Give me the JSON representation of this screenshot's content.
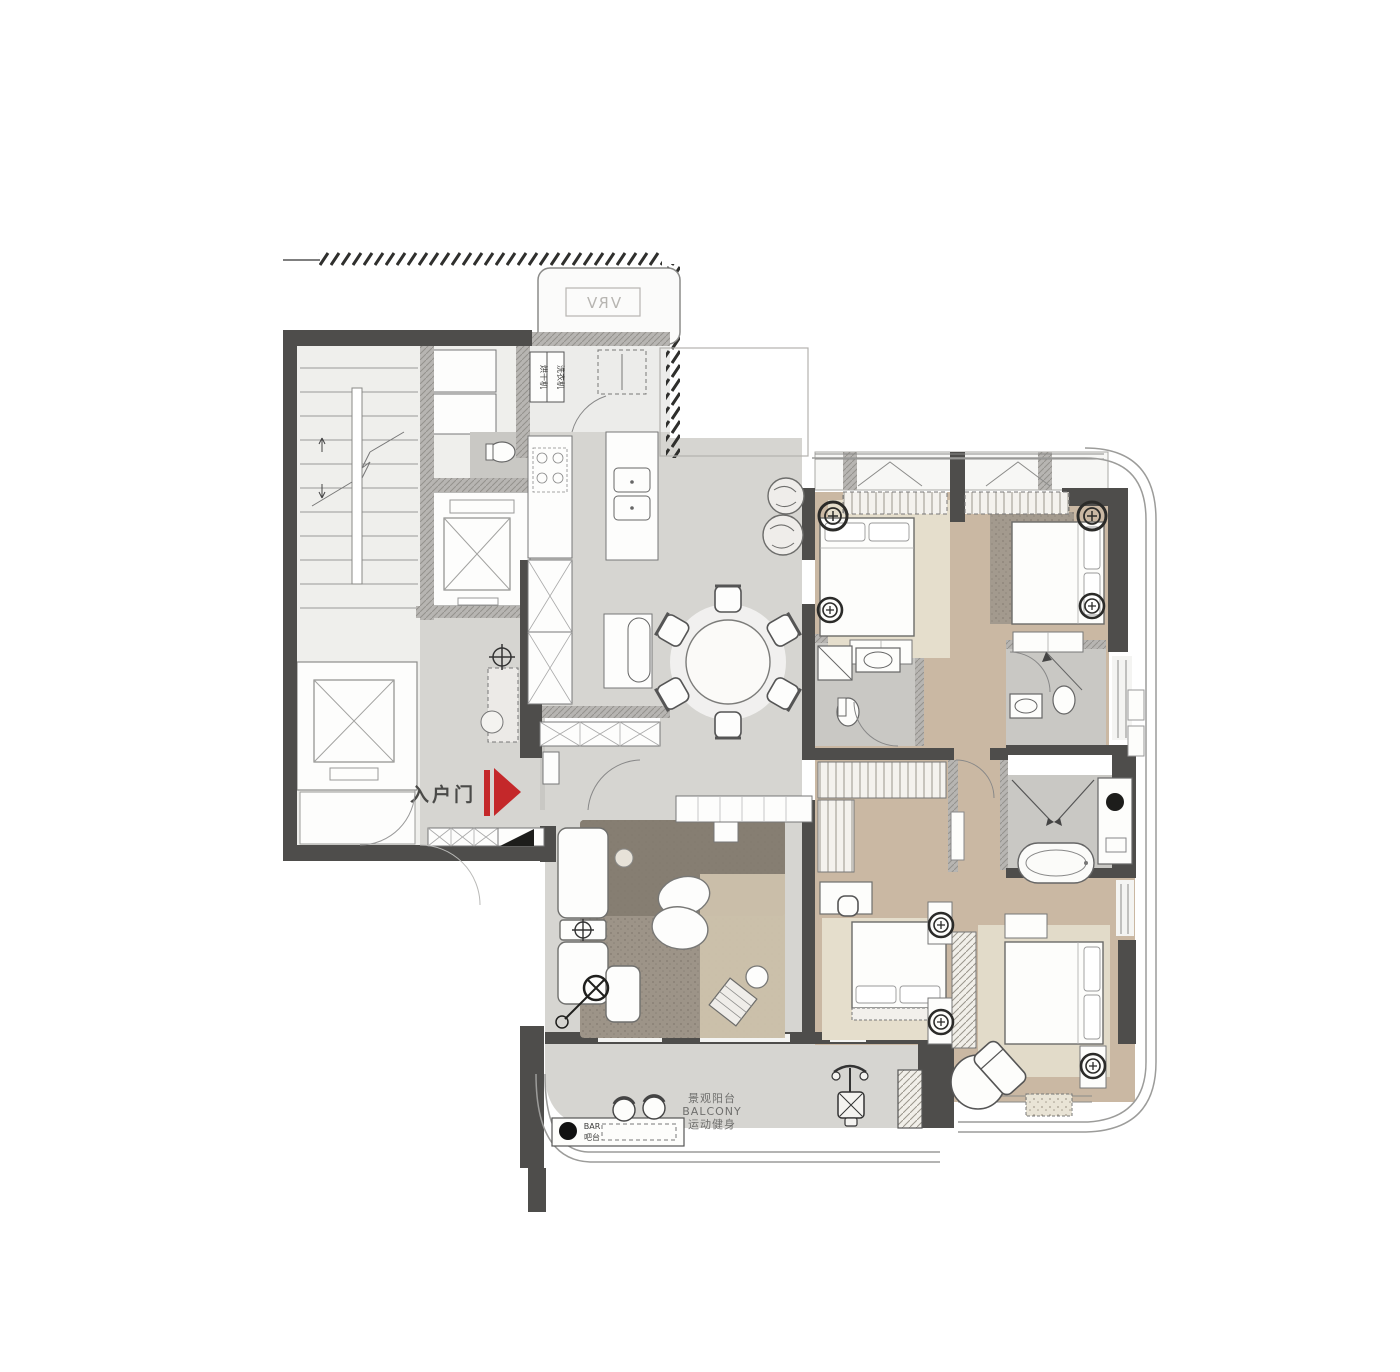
{
  "document": {
    "type": "residential-apartment-floor-plan",
    "orientation": "plan-view"
  },
  "labels": {
    "entrance_door": "入户门",
    "bar_title": "BAR",
    "bar_subtitle": "吧台",
    "balcony_name_cn": "景观阳台",
    "balcony_name_en": "BALCONY",
    "balcony_function": "运动健身",
    "vrv": "VRV",
    "laundry_dryer": "烘干机",
    "laundry_washer": "洗衣机"
  },
  "icons": {
    "entrance_arrow": "red-play-arrow",
    "elevator": "x-crossed-box",
    "stairs": "tread-lines-with-break",
    "dining_set": "round-table-six-chairs",
    "bathtub": "oval-tub",
    "toilet": "oval-wc",
    "exercise_bike": "spin-bike",
    "plant": "round-shrub",
    "wall_niche_symbol": "double-circle",
    "ceiling_light": "crosshair-circle",
    "floor_lamp": "circle-x-with-cord",
    "property_line": "diagonal-tick-band"
  },
  "palette": {
    "background": "#ffffff",
    "floor_gray": "#d6d5d1",
    "floor_wood": "#cab8a3",
    "floor_bath": "#c9c8c4",
    "floor_light": "#efefec",
    "wall_dark": "#4e4d4b",
    "wall_hatch": "#b7b5b2",
    "rug_light": "#e5decc",
    "rug_dark": "#8e8579",
    "accent_red": "#c4282a",
    "line": "#6b6b69"
  }
}
